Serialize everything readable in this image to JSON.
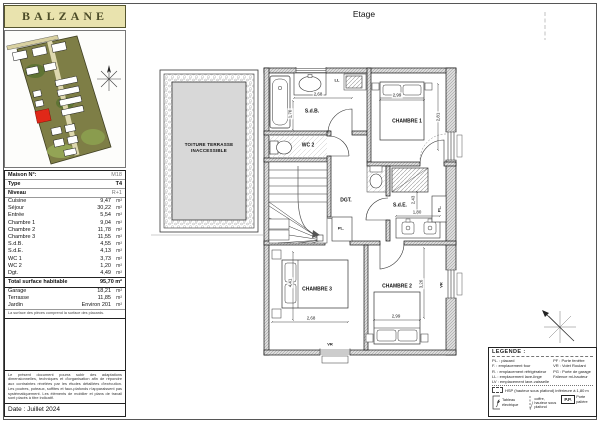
{
  "page": {
    "title": "Etage",
    "date_line": "Date : Juillet 2024"
  },
  "logo": {
    "text": "BALZANE"
  },
  "sidebar": {
    "info": [
      {
        "label": "Maison N°:",
        "value": "M18"
      },
      {
        "label": "Type",
        "value": "T4"
      },
      {
        "label": "Niveau",
        "value": "R+1"
      }
    ],
    "rooms": [
      {
        "label": "Cuisine",
        "value": "9,47",
        "unit": "m²"
      },
      {
        "label": "Séjour",
        "value": "30,22",
        "unit": "m²"
      },
      {
        "label": "Entrée",
        "value": "5,54",
        "unit": "m²"
      },
      {
        "label": "Chambre 1",
        "value": "9,04",
        "unit": "m²"
      },
      {
        "label": "Chambre 2",
        "value": "11,78",
        "unit": "m²"
      },
      {
        "label": "Chambre 3",
        "value": "11,55",
        "unit": "m²"
      },
      {
        "label": "S.d.B.",
        "value": "4,55",
        "unit": "m²"
      },
      {
        "label": "S.d.E.",
        "value": "4,13",
        "unit": "m²"
      },
      {
        "label": "WC 1",
        "value": "3,73",
        "unit": "m²"
      },
      {
        "label": "WC 2",
        "value": "1,20",
        "unit": "m²"
      },
      {
        "label": "Dgt.",
        "value": "4,49",
        "unit": "m²"
      }
    ],
    "total": {
      "label": "Total surface habitable",
      "value": "95,70 m²"
    },
    "extras": [
      {
        "label": "Garage",
        "value": "18,21",
        "unit": "m²"
      },
      {
        "label": "Terrasse",
        "value": "11,85",
        "unit": "m²"
      },
      {
        "label": "Jardin",
        "value": "Environ 201",
        "unit": "m²"
      }
    ],
    "note": "La surface des pièces comprend la surface des placards.",
    "disclaimer": "Le présent document pourra subir des adaptations dimensionnelles, techniques et d'organisation afin de répondre aux contraintes révélées par les études détaillées d'exécution. Les poutres, poteaux, soffites et faux-plafonds n'apparaissent pas systématiquement. Les éléments de mobilier et plans de travail sont placés à titre indicatif."
  },
  "plan": {
    "terrace": "TOITURE TERRASSE INACCESSIBLE",
    "rooms": {
      "sdb": "S.d.B.",
      "ch1": "CHAMBRE 1",
      "wc2": "WC 2",
      "dgt": "DGT.",
      "sde": "S.d.E.",
      "ch3": "CHAMBRE 3",
      "ch2": "CHAMBRE 2"
    },
    "dims": {
      "sdb_w": "2,68",
      "sdb_h": "1,70",
      "ch1_w": "2,99",
      "ch1_h": "2,81",
      "sde_h": "2,43",
      "sde_w": "1,80",
      "ch3_h": "4,41",
      "ch3_w": "2,68",
      "ch2_w": "2,99",
      "ch2_h": "3,26"
    },
    "tags": {
      "ll": "LL",
      "pl": "PL.",
      "vr": "VR"
    }
  },
  "legend": {
    "title": "LEGENDE :",
    "col_left": [
      "PL. : placard",
      "F. : emplacement four",
      "R. : emplacement réfrigérateur",
      "LL : emplacement lave-linge",
      "LV : emplacement lave-vaisselle"
    ],
    "col_right": [
      "PF : Porte fenêtre",
      "VR : Volet Roulant",
      "PG : Porte de garage",
      "Faïence mi-hauteur"
    ],
    "hsp_note": "HSP (hauteur sous plafond) inférieure à 1,80 m",
    "sym_tableau": "Tableau électrique",
    "sym_coffre": "coffre, hauteur sous plafond",
    "sym_pp_abbr": "P.P.",
    "sym_pp": "Porte palière"
  }
}
